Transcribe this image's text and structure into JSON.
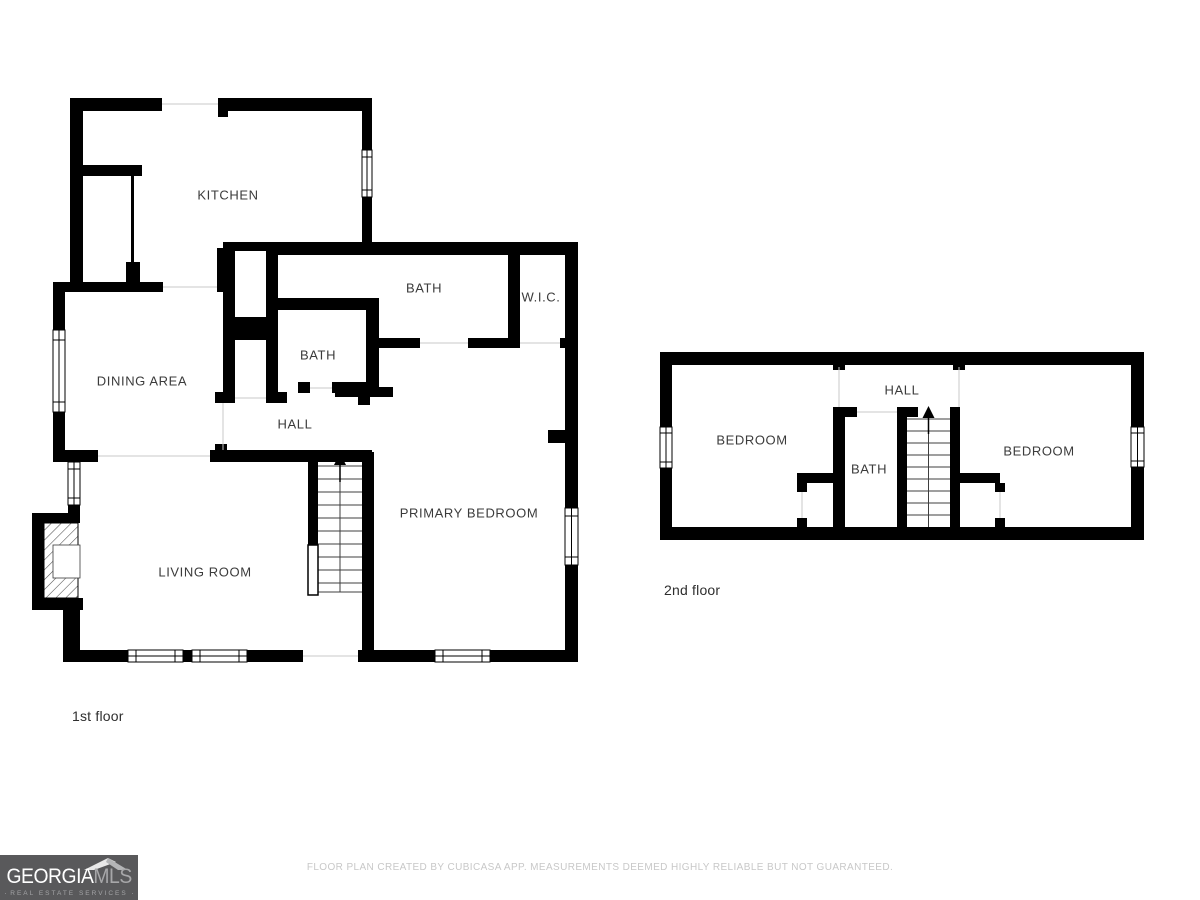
{
  "floors": {
    "first": {
      "label": "1st floor",
      "rooms": {
        "kitchen": "KITCHEN",
        "bath_upper": "BATH",
        "wic": "W.I.C.",
        "bath_lower": "BATH",
        "dining": "DINING AREA",
        "hall": "HALL",
        "primary_bedroom": "PRIMARY BEDROOM",
        "living_room": "LIVING ROOM"
      }
    },
    "second": {
      "label": "2nd floor",
      "rooms": {
        "hall": "HALL",
        "bedroom_left": "BEDROOM",
        "bath": "BATH",
        "bedroom_right": "BEDROOM"
      }
    }
  },
  "footer": {
    "disclaimer": "FLOOR PLAN CREATED BY CUBICASA APP. MEASUREMENTS DEEMED HIGHLY RELIABLE BUT NOT GUARANTEED.",
    "logo": {
      "brand_primary": "GEORGIA",
      "brand_secondary": "MLS",
      "tagline": "REAL ESTATE SERVICES",
      "bg": "#59595b",
      "primary_color": "#ffffff",
      "secondary_color": "#a7a7a9"
    }
  },
  "colors": {
    "wall": "#000000",
    "label_text": "#3b3b3b",
    "separator_line": "#c9c9c9",
    "disclaimer_text": "#c8c8c8"
  }
}
